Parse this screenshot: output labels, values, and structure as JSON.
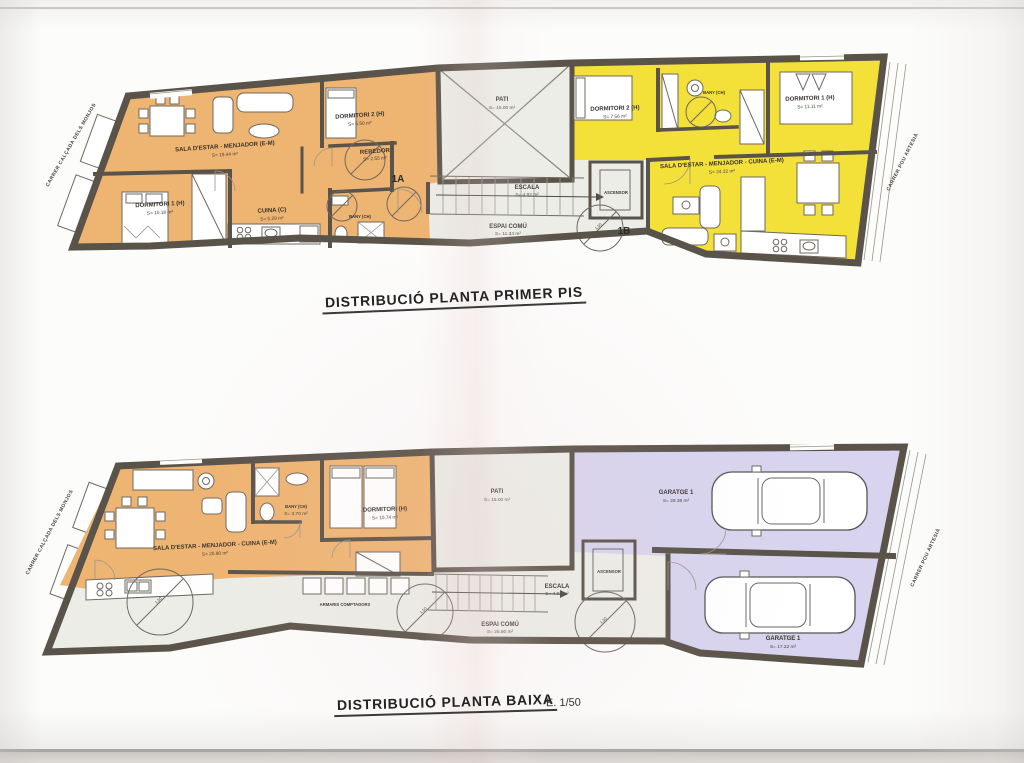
{
  "colors": {
    "unit_orange": "#eeb472",
    "unit_yellow": "#f3e139",
    "garage_lavender": "#d8d4ef",
    "common_floor": "#ecede7",
    "wall": "#5a534a",
    "paper": "#fcfcfb"
  },
  "annotations": {
    "turning_circle": "1.50"
  },
  "plans": [
    {
      "title": "DISTRIBUCIÓ PLANTA PRIMER PIS",
      "streets": {
        "left": "CARRER CALÇADA DELS MONJOS",
        "right": "CARRER POU ARTESIÀ"
      },
      "unit_a": {
        "id": "1A",
        "rooms": [
          {
            "name": "SALA D'ESTAR - MENJADOR (E-M)",
            "area": "S= 19.44 m²"
          },
          {
            "name": "DORMITORI 1 (H)",
            "area": "S= 10.18 m²"
          },
          {
            "name": "DORMITORI 2 (H)",
            "area": "S= 5.50 m²"
          },
          {
            "name": "CUINA (C)",
            "area": "S= 5.29 m²"
          },
          {
            "name": "REBEDOR",
            "area": "S= 2.55 m²"
          },
          {
            "name": "BANY (CH)",
            "area": ""
          }
        ]
      },
      "unit_b": {
        "id": "1B",
        "rooms": [
          {
            "name": "DORMITORI 2 (H)",
            "area": "S= 7.56 m²"
          },
          {
            "name": "BANY (CH)",
            "area": ""
          },
          {
            "name": "DORMITORI 1 (H)",
            "area": "S= 11.11 m²"
          },
          {
            "name": "SALA D'ESTAR - MENJADOR - CUINA (E-M)",
            "area": "S= 24.32 m²"
          }
        ]
      },
      "common": {
        "pati": {
          "name": "PATI",
          "area": "S= 15.00 m²"
        },
        "escala": {
          "name": "ESCALA",
          "area": "S= 4.92 m²"
        },
        "espai_comu": {
          "name": "ESPAI COMÚ",
          "area": "S= 11.34 m²"
        },
        "ascensor": {
          "name": "ASCENSOR"
        }
      }
    },
    {
      "title": "DISTRIBUCIÓ PLANTA BAIXA",
      "scale": "E. 1/50",
      "streets": {
        "left": "CARRER CALÇADA DELS MONJOS",
        "right": "CARRER POU ARTESIÀ"
      },
      "unit": {
        "rooms": [
          {
            "name": "SALA D'ESTAR - MENJADOR - CUINA (E-M)",
            "area": "S= 20.80 m²"
          },
          {
            "name": "BANY (CH)",
            "area": "S= 3.70 m²"
          },
          {
            "name": "DORMITORI (H)",
            "area": "S= 10.74 m²"
          }
        ]
      },
      "common": {
        "pati": {
          "name": "PATI",
          "area": "S= 15.00 m²"
        },
        "escala": {
          "name": "ESCALA",
          "area": "S= 4.92 m²"
        },
        "espai_comu": {
          "name": "ESPAI COMÚ",
          "area": "S= 25.80 m²"
        },
        "ascensor": {
          "name": "ASCENSOR"
        },
        "armaris": {
          "name": "ARMARIS COMPTADORS"
        }
      },
      "garages": [
        {
          "name": "GARATGE 1",
          "area": "S= 28.38 m²"
        },
        {
          "name": "GARATGE 1",
          "area": "S= 17.22 m²"
        }
      ]
    }
  ]
}
